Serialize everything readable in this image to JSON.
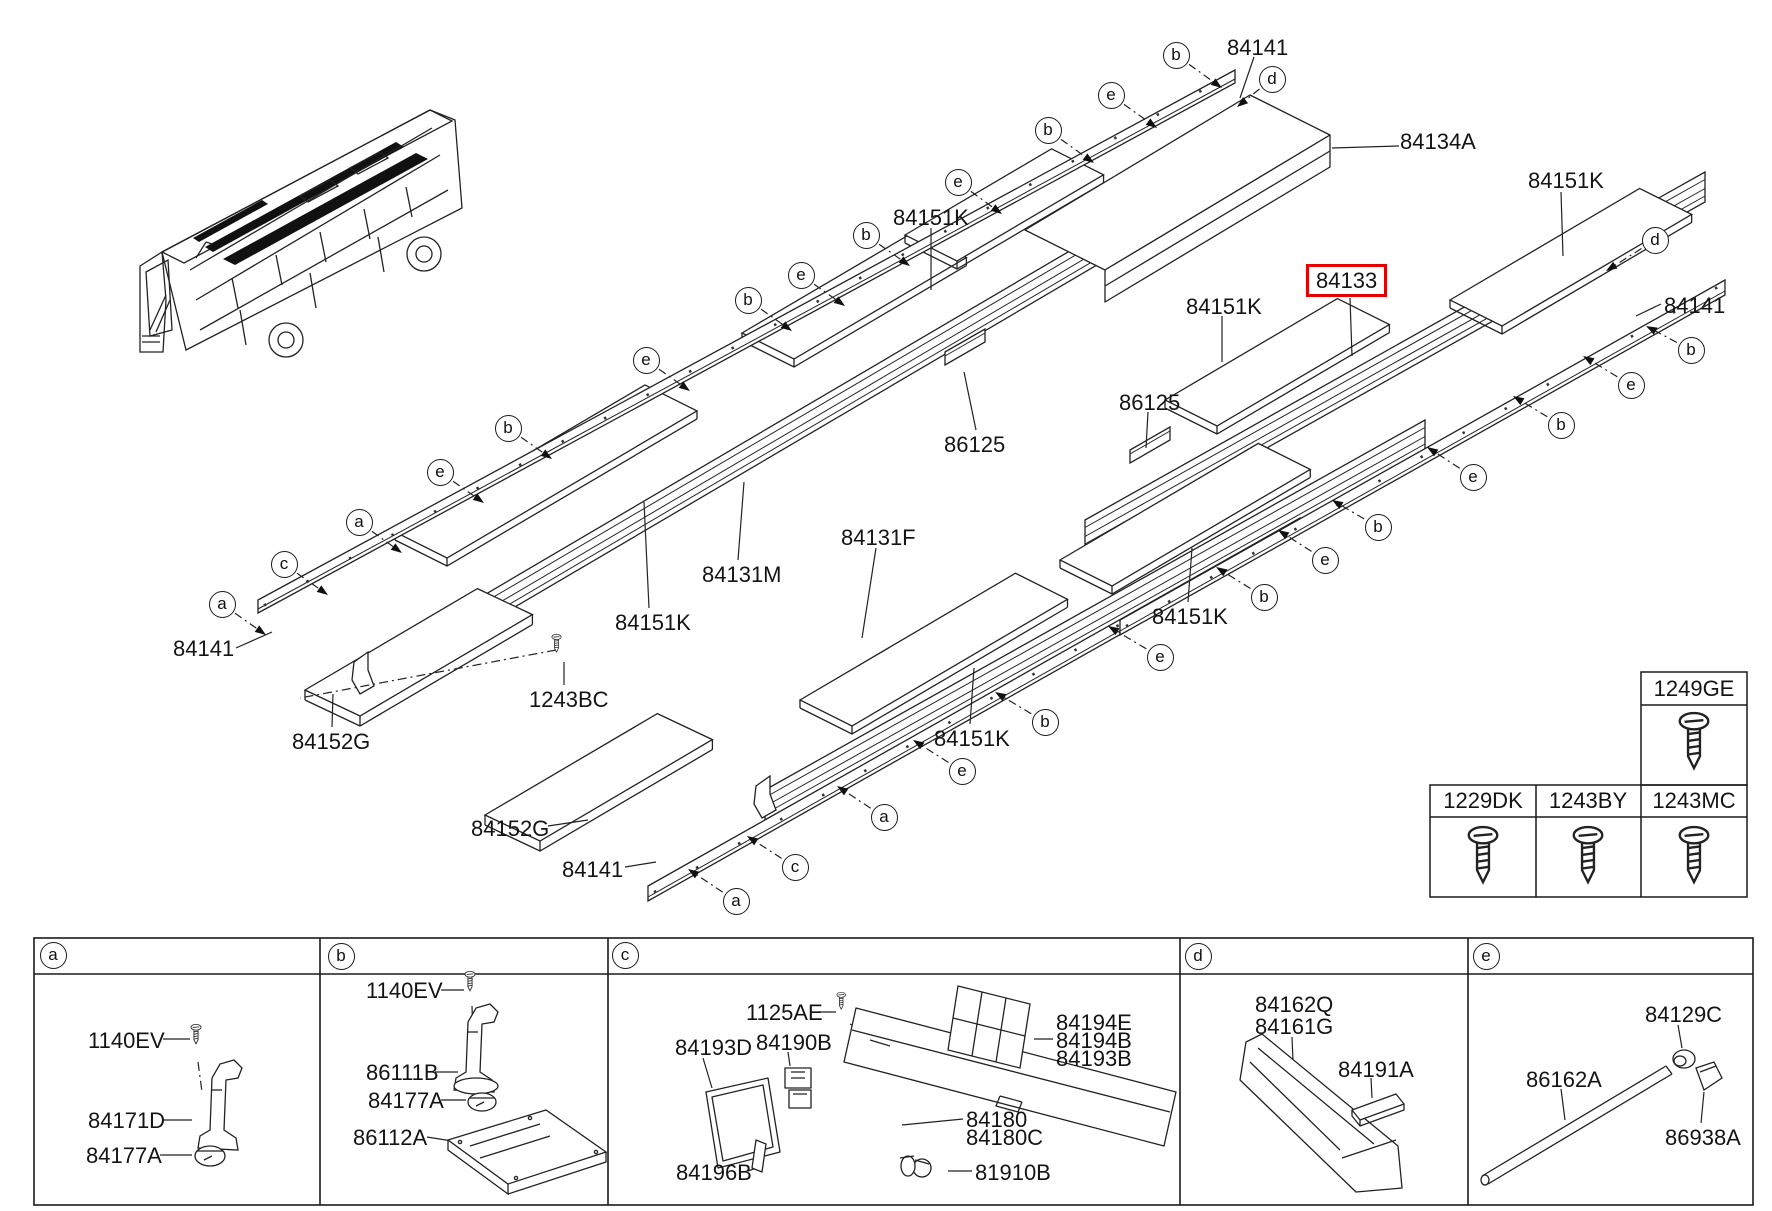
{
  "diagram": {
    "highlight": {
      "part_no": "84133",
      "box_color": "#e60000"
    },
    "part_labels": [
      {
        "text": "84141",
        "x": 1227,
        "y": 35
      },
      {
        "text": "84134A",
        "x": 1400,
        "y": 129
      },
      {
        "text": "84151K",
        "x": 1528,
        "y": 168
      },
      {
        "text": "84141",
        "x": 1664,
        "y": 293
      },
      {
        "text": "84133",
        "x": 1306,
        "y": 264,
        "boxed": true
      },
      {
        "text": "84151K",
        "x": 1186,
        "y": 294
      },
      {
        "text": "84151K",
        "x": 893,
        "y": 205
      },
      {
        "text": "86125",
        "x": 1119,
        "y": 390
      },
      {
        "text": "86125",
        "x": 944,
        "y": 432
      },
      {
        "text": "84131F",
        "x": 841,
        "y": 525
      },
      {
        "text": "84131M",
        "x": 702,
        "y": 562
      },
      {
        "text": "84151K",
        "x": 615,
        "y": 610
      },
      {
        "text": "84151K",
        "x": 1152,
        "y": 604
      },
      {
        "text": "84151K",
        "x": 934,
        "y": 726
      },
      {
        "text": "1243BC",
        "x": 529,
        "y": 687
      },
      {
        "text": "84141",
        "x": 173,
        "y": 636
      },
      {
        "text": "84152G",
        "x": 292,
        "y": 729
      },
      {
        "text": "84152G",
        "x": 471,
        "y": 816
      },
      {
        "text": "84141",
        "x": 562,
        "y": 857
      },
      {
        "text": "1140EV",
        "x": 88,
        "y": 1028
      },
      {
        "text": "84171D",
        "x": 88,
        "y": 1108
      },
      {
        "text": "84177A",
        "x": 86,
        "y": 1143
      },
      {
        "text": "1140EV",
        "x": 366,
        "y": 978
      },
      {
        "text": "86111B",
        "x": 366,
        "y": 1060
      },
      {
        "text": "84177A",
        "x": 368,
        "y": 1088
      },
      {
        "text": "86112A",
        "x": 353,
        "y": 1125
      },
      {
        "text": "1125AE",
        "x": 746,
        "y": 1000
      },
      {
        "text": "84193D",
        "x": 675,
        "y": 1035
      },
      {
        "text": "84190B",
        "x": 756,
        "y": 1030
      },
      {
        "text": "84194E",
        "x": 1056,
        "y": 1010
      },
      {
        "text": "84194B",
        "x": 1056,
        "y": 1028
      },
      {
        "text": "84193B",
        "x": 1056,
        "y": 1046
      },
      {
        "text": "84180",
        "x": 966,
        "y": 1107
      },
      {
        "text": "84180C",
        "x": 966,
        "y": 1125
      },
      {
        "text": "84196B",
        "x": 676,
        "y": 1160
      },
      {
        "text": "81910B",
        "x": 975,
        "y": 1160
      },
      {
        "text": "84162Q",
        "x": 1255,
        "y": 992
      },
      {
        "text": "84161G",
        "x": 1255,
        "y": 1014
      },
      {
        "text": "84191A",
        "x": 1338,
        "y": 1057
      },
      {
        "text": "84129C",
        "x": 1645,
        "y": 1002
      },
      {
        "text": "86162A",
        "x": 1526,
        "y": 1067
      },
      {
        "text": "86938A",
        "x": 1665,
        "y": 1125
      }
    ],
    "callouts": [
      {
        "letter": "b",
        "x": 1176,
        "y": 55,
        "tx": 1222,
        "ty": 88
      },
      {
        "letter": "e",
        "x": 1111,
        "y": 95,
        "tx": 1157,
        "ty": 128
      },
      {
        "letter": "b",
        "x": 1048,
        "y": 130,
        "tx": 1094,
        "ty": 163
      },
      {
        "letter": "e",
        "x": 958,
        "y": 182,
        "tx": 1002,
        "ty": 214
      },
      {
        "letter": "b",
        "x": 866,
        "y": 235,
        "tx": 910,
        "ty": 266
      },
      {
        "letter": "e",
        "x": 801,
        "y": 275,
        "tx": 845,
        "ty": 306
      },
      {
        "letter": "b",
        "x": 748,
        "y": 300,
        "tx": 792,
        "ty": 331
      },
      {
        "letter": "e",
        "x": 646,
        "y": 360,
        "tx": 690,
        "ty": 391
      },
      {
        "letter": "b",
        "x": 508,
        "y": 428,
        "tx": 552,
        "ty": 459
      },
      {
        "letter": "e",
        "x": 440,
        "y": 472,
        "tx": 484,
        "ty": 503
      },
      {
        "letter": "a",
        "x": 359,
        "y": 522,
        "tx": 402,
        "ty": 553
      },
      {
        "letter": "c",
        "x": 284,
        "y": 564,
        "tx": 328,
        "ty": 595
      },
      {
        "letter": "a",
        "x": 222,
        "y": 604,
        "tx": 266,
        "ty": 635
      },
      {
        "letter": "d",
        "x": 1272,
        "y": 79,
        "tx": 1237,
        "ty": 107
      },
      {
        "letter": "d",
        "x": 1655,
        "y": 240,
        "tx": 1606,
        "ty": 271
      },
      {
        "letter": "b",
        "x": 1691,
        "y": 350,
        "tx": 1646,
        "ty": 326
      },
      {
        "letter": "e",
        "x": 1631,
        "y": 385,
        "tx": 1583,
        "ty": 356
      },
      {
        "letter": "b",
        "x": 1561,
        "y": 425,
        "tx": 1513,
        "ty": 396
      },
      {
        "letter": "e",
        "x": 1473,
        "y": 477,
        "tx": 1427,
        "ty": 447
      },
      {
        "letter": "b",
        "x": 1378,
        "y": 527,
        "tx": 1332,
        "ty": 500
      },
      {
        "letter": "e",
        "x": 1325,
        "y": 560,
        "tx": 1278,
        "ty": 530
      },
      {
        "letter": "b",
        "x": 1264,
        "y": 597,
        "tx": 1216,
        "ty": 567
      },
      {
        "letter": "e",
        "x": 1160,
        "y": 657,
        "tx": 1108,
        "ty": 626
      },
      {
        "letter": "b",
        "x": 1045,
        "y": 722,
        "tx": 995,
        "ty": 692
      },
      {
        "letter": "e",
        "x": 962,
        "y": 771,
        "tx": 913,
        "ty": 740
      },
      {
        "letter": "a",
        "x": 884,
        "y": 817,
        "tx": 837,
        "ty": 786
      },
      {
        "letter": "c",
        "x": 795,
        "y": 867,
        "tx": 747,
        "ty": 836
      },
      {
        "letter": "a",
        "x": 736,
        "y": 901,
        "tx": 688,
        "ty": 869
      }
    ]
  },
  "fastener_table": {
    "cells": [
      {
        "part_no": "1249GE",
        "x": 1694,
        "y": 676
      },
      {
        "part_no": "1229DK",
        "x": 1483,
        "y": 788
      },
      {
        "part_no": "1243BY",
        "x": 1588,
        "y": 788
      },
      {
        "part_no": "1243MC",
        "x": 1694,
        "y": 788
      }
    ]
  },
  "detail_panels": [
    {
      "letter": "a",
      "cx": 53,
      "cy": 955
    },
    {
      "letter": "b",
      "cx": 341,
      "cy": 956
    },
    {
      "letter": "c",
      "cx": 625,
      "cy": 955
    },
    {
      "letter": "d",
      "cx": 1198,
      "cy": 956
    },
    {
      "letter": "e",
      "cx": 1486,
      "cy": 956
    }
  ]
}
